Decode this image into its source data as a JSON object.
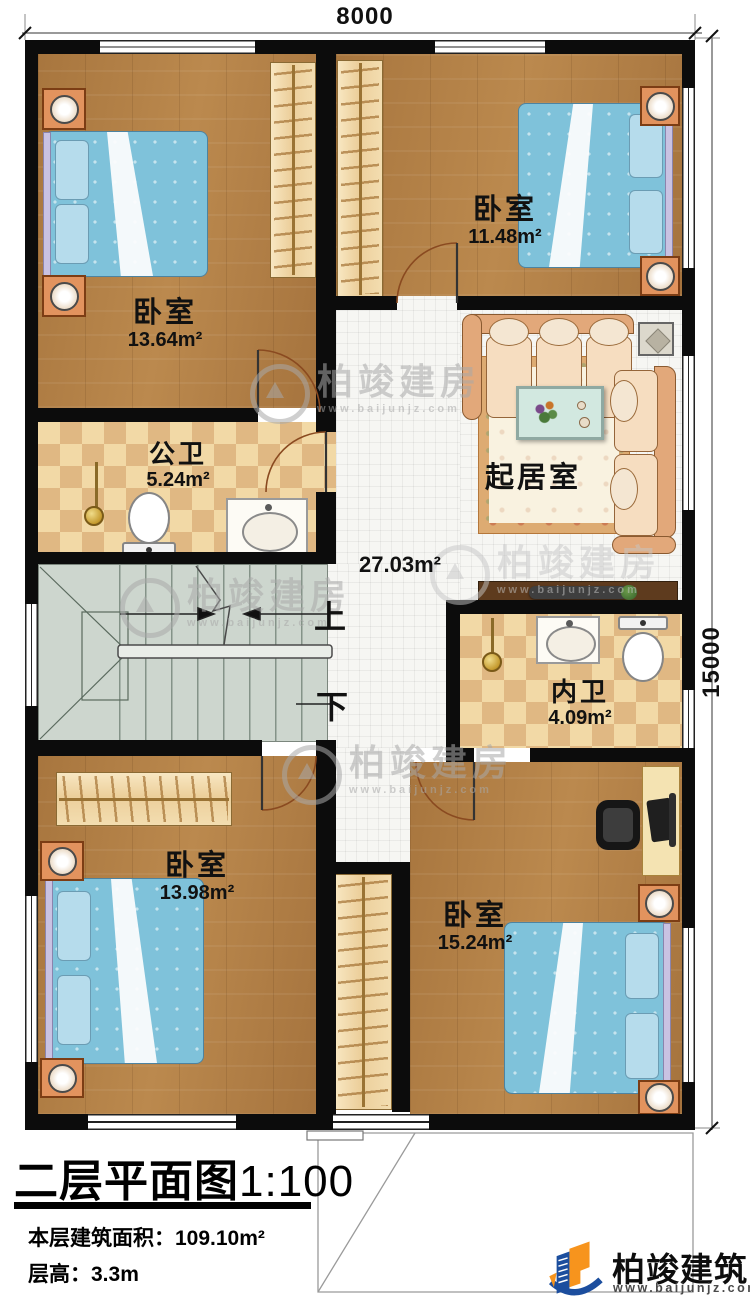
{
  "plan": {
    "dimensions": {
      "top": "8000",
      "right": "15000"
    },
    "rooms": [
      {
        "name": "卧室",
        "area": "13.64m²"
      },
      {
        "name": "卧室",
        "area": "11.48m²"
      },
      {
        "name": "公卫",
        "area": "5.24m²"
      },
      {
        "name": "起居室",
        "area": "27.03m²"
      },
      {
        "name": "内卫",
        "area": "4.09m²"
      },
      {
        "name": "卧室",
        "area": "13.98m²"
      },
      {
        "name": "卧室",
        "area": "15.24m²"
      }
    ],
    "stairs": {
      "up": "上",
      "down": "下"
    }
  },
  "titleblock": {
    "title": "二层平面图",
    "scale": "1:100",
    "floor_area_label": "本层建筑面积：",
    "floor_area_value": "109.10m²",
    "floor_height_label": "层高：",
    "floor_height_value": "3.3m"
  },
  "brand": {
    "name": "柏竣建筑",
    "website": "www.baijunjz.com"
  },
  "watermark": {
    "text": "柏竣建房",
    "website": "www.baijunjz.com"
  },
  "colors": {
    "wall": "#0c0c0c",
    "wood_floor": "#b5834a",
    "bath_tile_light": "#f2d9a6",
    "bath_tile_dark": "#e0b883",
    "stair": "#cdd6ce",
    "bed": "#7fc2da",
    "sofa": "#e2a87a",
    "brand_blue": "#1c4e9e",
    "brand_orange": "#f7941d"
  }
}
